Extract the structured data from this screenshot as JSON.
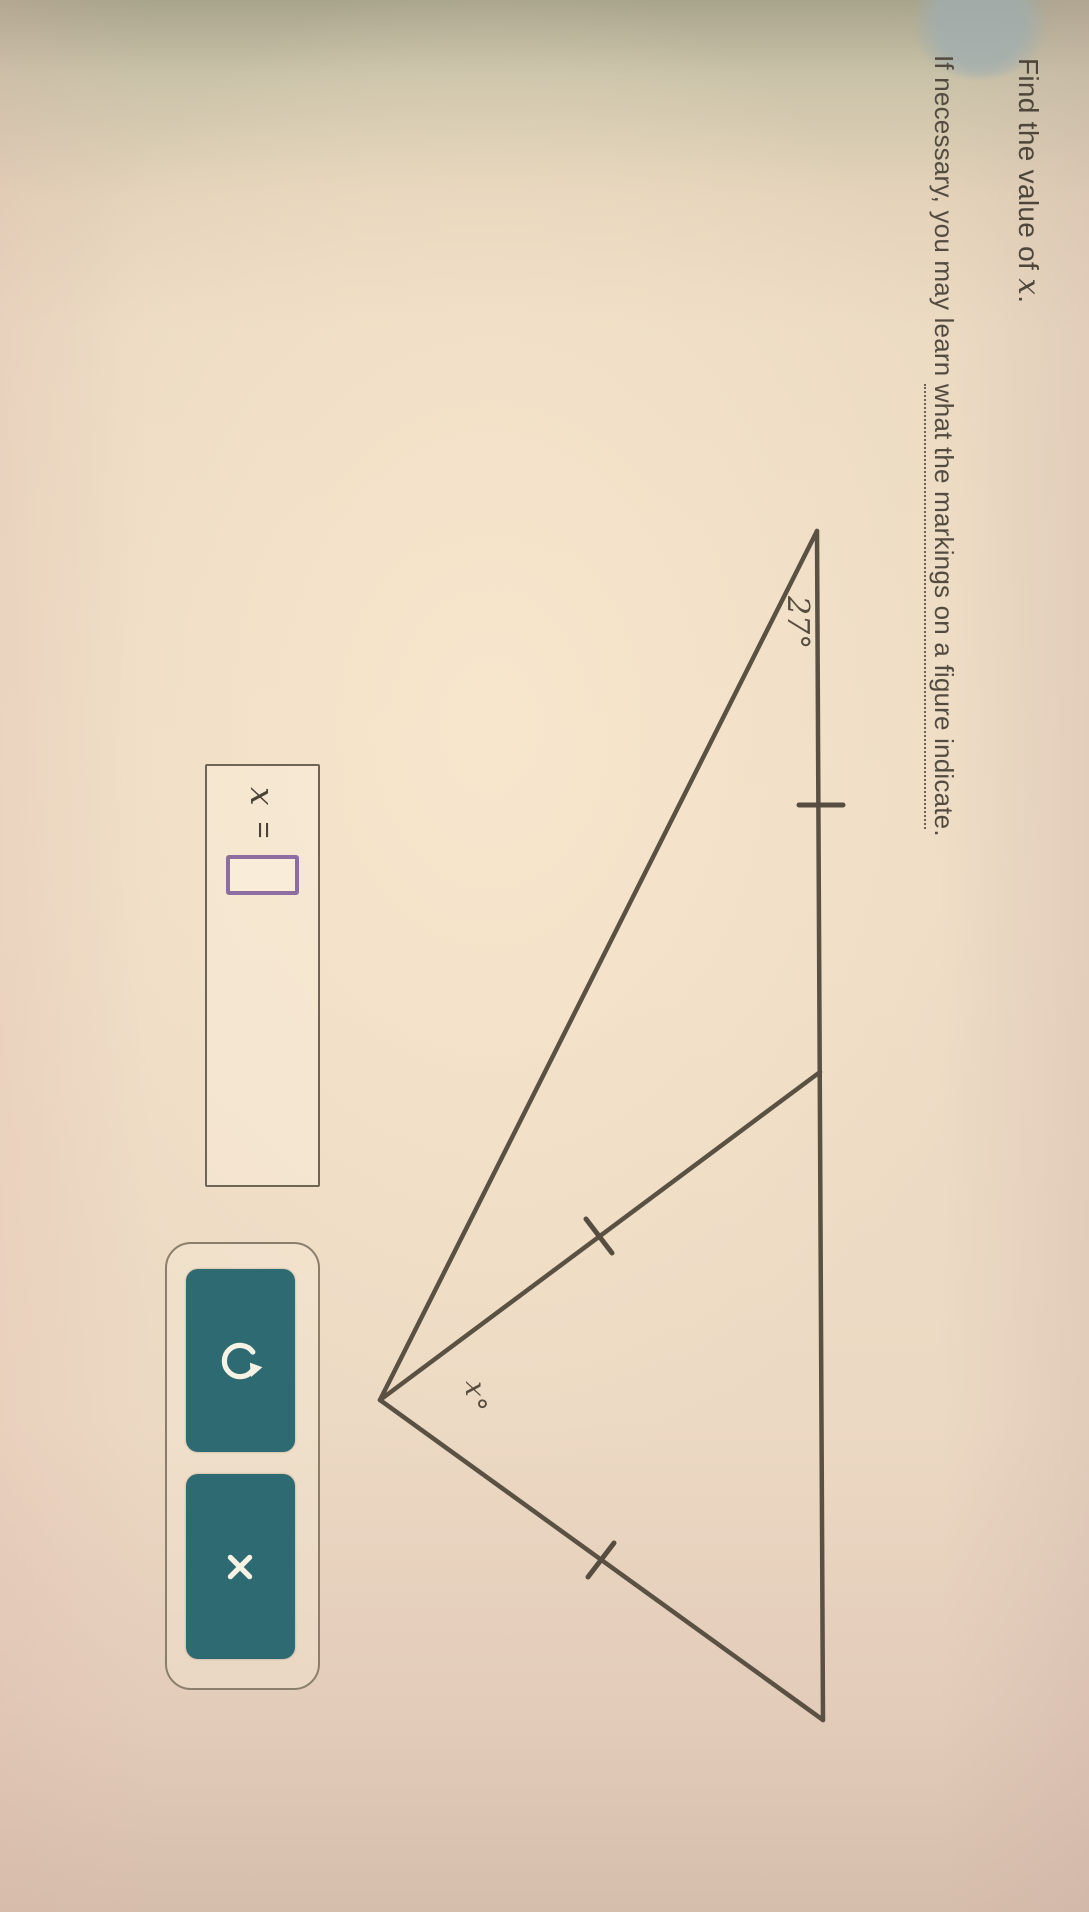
{
  "question": {
    "line1": {
      "prefix": "Find the value of ",
      "variable": "x",
      "suffix": "."
    },
    "line2": {
      "prefix": "If necessary, you may learn ",
      "link": "what the markings on a figure indicate",
      "suffix": "."
    }
  },
  "figure": {
    "type": "geometry-triangle-with-cevian",
    "angle_left_label": "27°",
    "angle_apex_label": "x°",
    "markings": {
      "top_left_segment_ticks": 1,
      "cevian_ticks": 1,
      "right_side_ticks": 1
    }
  },
  "answer_panel": {
    "variable": "x",
    "equals_sign": "=",
    "input_value": ""
  },
  "toolbar": {
    "buttons": [
      {
        "name": "undo",
        "icon": "undo-arrow-icon"
      },
      {
        "name": "clear",
        "icon": "x-mark-icon"
      }
    ]
  },
  "colors": {
    "button_teal": "#2e6a72",
    "input_purple": "#8e6da0",
    "ink": "#4e463a",
    "figure_line": "#5a5143",
    "background_beige": "#ecdbc3"
  }
}
